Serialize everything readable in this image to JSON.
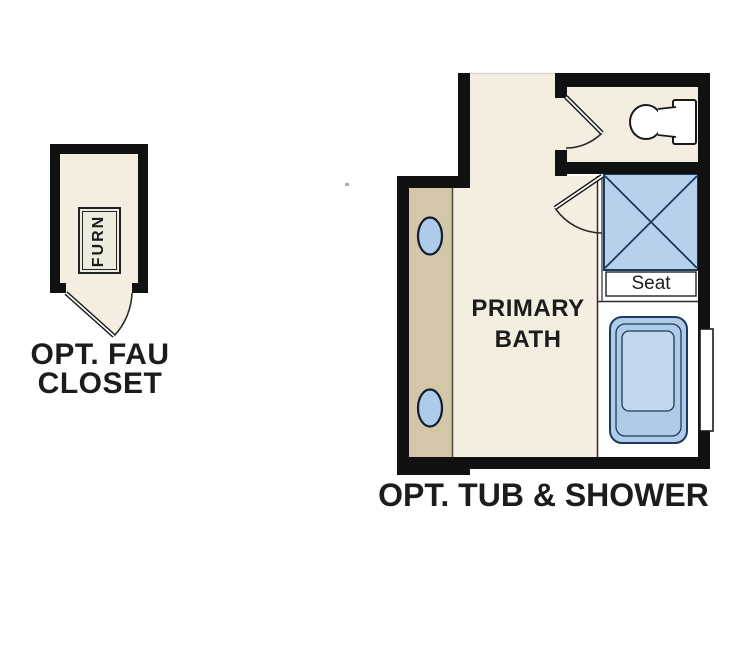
{
  "figure_title": "Primary bath options floor plan",
  "palette": {
    "wall": "#111111",
    "floor": "#f4eee0",
    "vanity": "#d3c6a9",
    "vanity_edge": "#4e4a40",
    "fixture_blue": "#aecbe9",
    "shower_blue": "#b7d1ec",
    "tub_blue": "#afcbe8",
    "tub_basin": "#c2d8ef",
    "line_navy": "#1b3a5f",
    "text": "#1c1c1c"
  },
  "closet": {
    "furn_label": "FURN",
    "label_lines": [
      "OPT. FAU",
      "CLOSET"
    ]
  },
  "bath": {
    "room_label_lines": [
      "PRIMARY",
      "BATH"
    ],
    "seat_label": "Seat",
    "caption": "OPT. TUB & SHOWER"
  }
}
